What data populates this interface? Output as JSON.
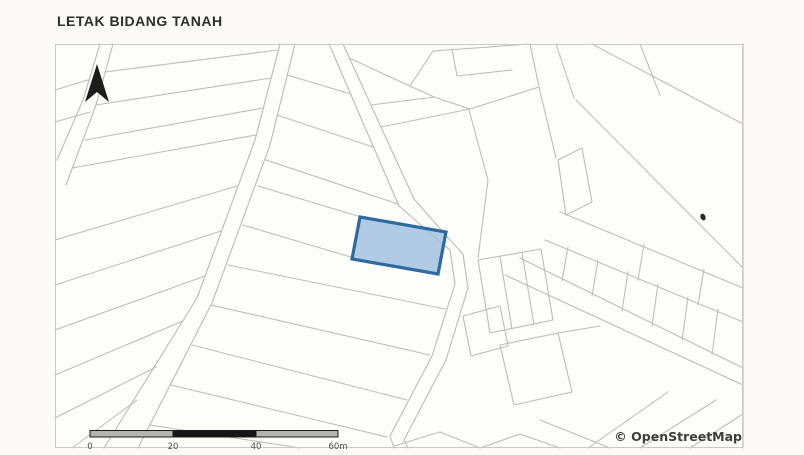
{
  "page": {
    "background": "#fbfaf6"
  },
  "header": {
    "title": "LETAK BIDANG TANAH"
  },
  "map": {
    "background": "#fdfdfa",
    "frame_color": "#ccc9c3",
    "line_color": "#bdbcb7",
    "attribution": "© OpenStreetMap",
    "north_arrow_color": "#1c1c1c",
    "speck_color": "#2a2a2a",
    "highlight": {
      "fill": "#a5c2e1",
      "fill_opacity": "0.85",
      "stroke": "#2d6a9f",
      "stroke_width": "3.2"
    },
    "scale_bar": {
      "ticks": [
        "0",
        "20",
        "40",
        "60m"
      ],
      "bar_light": "#b5b3ae",
      "bar_dark": "#161616",
      "label_color": "#4b4b4a"
    }
  }
}
